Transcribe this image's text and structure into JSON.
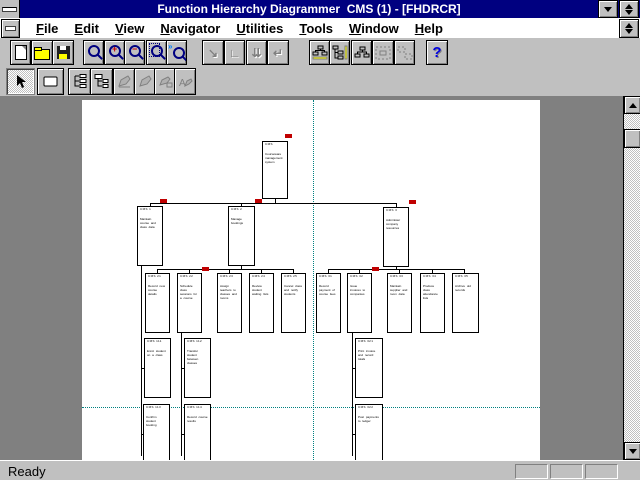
{
  "window": {
    "title": "Function Hierarchy Diagrammer  CMS (1) - [FHDRCR]",
    "buttons": {
      "minimize": "minimize",
      "restore": "restore",
      "system_menu": "system-menu"
    }
  },
  "menu": {
    "items": [
      {
        "label": "File"
      },
      {
        "label": "Edit"
      },
      {
        "label": "View"
      },
      {
        "label": "Navigator"
      },
      {
        "label": "Utilities"
      },
      {
        "label": "Tools"
      },
      {
        "label": "Window"
      },
      {
        "label": "Help"
      }
    ]
  },
  "toolbar_row1": [
    {
      "name": "new-button",
      "icon": "new",
      "x": 10,
      "w": 19,
      "enabled": true
    },
    {
      "name": "open-button",
      "icon": "open",
      "x": 31,
      "w": 20,
      "enabled": true
    },
    {
      "name": "save-button",
      "icon": "save",
      "x": 52,
      "w": 20,
      "enabled": true
    },
    {
      "name": "zoom-button",
      "icon": "mag",
      "x": 83,
      "w": 19,
      "enabled": true
    },
    {
      "name": "zoom-in-button",
      "icon": "magplus",
      "x": 104,
      "w": 19,
      "enabled": true
    },
    {
      "name": "zoom-out-button",
      "icon": "magminus",
      "x": 124,
      "w": 19,
      "enabled": true
    },
    {
      "name": "zoom-fit-button",
      "icon": "magpage",
      "x": 146,
      "w": 19,
      "enabled": true
    },
    {
      "name": "zoom-selection-button",
      "icon": "magsel",
      "x": 166,
      "w": 19,
      "enabled": true
    },
    {
      "name": "expand-node-button",
      "icon": "arr1",
      "x": 202,
      "w": 20,
      "enabled": false
    },
    {
      "name": "collapse-node-button",
      "icon": "arr2",
      "x": 224,
      "w": 19,
      "enabled": false
    },
    {
      "name": "expand-all-button",
      "icon": "arr3",
      "x": 246,
      "w": 19,
      "enabled": false
    },
    {
      "name": "collapse-all-button",
      "icon": "arr4",
      "x": 267,
      "w": 20,
      "enabled": false
    },
    {
      "name": "layout-horizontal-button",
      "icon": "lay1",
      "x": 309,
      "w": 19,
      "enabled": true
    },
    {
      "name": "layout-vertical-button",
      "icon": "lay2",
      "x": 329,
      "w": 19,
      "enabled": true
    },
    {
      "name": "layout-hybrid-button",
      "icon": "lay3",
      "x": 351,
      "w": 19,
      "enabled": true
    },
    {
      "name": "layout-selection-button",
      "icon": "lay4",
      "x": 372,
      "w": 20,
      "enabled": false
    },
    {
      "name": "layout-compact-button",
      "icon": "lay5",
      "x": 394,
      "w": 19,
      "enabled": false
    },
    {
      "name": "help-button",
      "icon": "help",
      "x": 426,
      "w": 20,
      "enabled": true
    }
  ],
  "toolbar_row2": [
    {
      "name": "select-tool",
      "icon": "cursor",
      "x": 6,
      "w": 27,
      "enabled": true,
      "pressed": true
    },
    {
      "name": "function-box-tool",
      "icon": "rect",
      "x": 37,
      "w": 25,
      "enabled": true
    },
    {
      "name": "expand-hierarchy-tool",
      "icon": "tree1",
      "x": 68,
      "w": 21,
      "enabled": true
    },
    {
      "name": "collapse-hierarchy-tool",
      "icon": "tree2",
      "x": 90,
      "w": 21,
      "enabled": true
    },
    {
      "name": "edit-function-tool",
      "icon": "pen1",
      "x": 113,
      "w": 20,
      "enabled": false
    },
    {
      "name": "edit-label-tool",
      "icon": "pen2",
      "x": 134,
      "w": 20,
      "enabled": false
    },
    {
      "name": "fill-color-tool",
      "icon": "pen3",
      "x": 154,
      "w": 20,
      "enabled": false
    },
    {
      "name": "text-style-tool",
      "icon": "pen4",
      "x": 174,
      "w": 20,
      "enabled": false
    }
  ],
  "statusbar": {
    "ready": "Ready",
    "panel_count": 3
  },
  "colors": {
    "titlebar": "#000080",
    "desktop": "#808080",
    "chrome": "#C0C0C0",
    "flag": "#C00000",
    "guide": "#008080",
    "help_icon": "#0000E0"
  },
  "diagram": {
    "guides": {
      "vertical_x": 231,
      "horizontal_y": 307
    },
    "flags": [
      [
        203,
        34
      ],
      [
        78,
        99
      ],
      [
        173,
        99
      ],
      [
        327,
        100
      ],
      [
        120,
        167
      ],
      [
        290,
        167
      ]
    ],
    "connectors": [
      [
        193,
        99,
        1,
        4
      ],
      [
        68,
        103,
        247,
        1
      ],
      [
        68,
        104,
        1,
        3
      ],
      [
        159,
        104,
        1,
        3
      ],
      [
        314,
        104,
        1,
        4
      ],
      [
        159,
        166,
        1,
        3
      ],
      [
        75,
        169,
        137,
        1
      ],
      [
        75,
        170,
        1,
        3
      ],
      [
        107,
        170,
        1,
        3
      ],
      [
        147,
        170,
        1,
        3
      ],
      [
        179,
        170,
        1,
        3
      ],
      [
        211,
        170,
        1,
        3
      ],
      [
        314,
        167,
        1,
        2
      ],
      [
        246,
        169,
        137,
        1
      ],
      [
        246,
        170,
        1,
        3
      ],
      [
        277,
        170,
        1,
        3
      ],
      [
        317,
        170,
        1,
        3
      ],
      [
        350,
        170,
        1,
        3
      ],
      [
        382,
        170,
        1,
        3
      ],
      [
        59,
        166,
        1,
        190
      ],
      [
        99,
        233,
        1,
        123
      ],
      [
        270,
        233,
        1,
        123
      ],
      [
        59,
        268,
        4,
        1
      ],
      [
        99,
        268,
        4,
        1
      ],
      [
        270,
        268,
        4,
        1
      ],
      [
        59,
        334,
        4,
        1
      ],
      [
        99,
        334,
        4,
        1
      ],
      [
        270,
        334,
        4,
        1
      ],
      [
        276,
        238,
        1,
        60
      ],
      [
        276,
        304,
        1,
        56
      ]
    ],
    "boxes": [
      {
        "id": "root-function",
        "x": 180,
        "y": 41,
        "w": 26,
        "h": 58,
        "code": "CMS",
        "desc": "Courseware management system"
      },
      {
        "id": "function-1",
        "x": 55,
        "y": 106,
        "w": 26,
        "h": 60,
        "code": "CMS 1",
        "desc": "Maintain course and class data"
      },
      {
        "id": "function-2",
        "x": 146,
        "y": 106,
        "w": 27,
        "h": 60,
        "code": "CMS 2",
        "desc": "Manage bookings"
      },
      {
        "id": "function-3",
        "x": 301,
        "y": 107,
        "w": 26,
        "h": 60,
        "code": "CMS 3",
        "desc": "Administer company resources"
      },
      {
        "id": "function-2-1",
        "x": 63,
        "y": 173,
        "w": 25,
        "h": 60,
        "code": "CMS 21",
        "desc": "Record new course details"
      },
      {
        "id": "function-2-2",
        "x": 95,
        "y": 173,
        "w": 25,
        "h": 60,
        "code": "CMS 22",
        "desc": "Schedule class sessions for a course"
      },
      {
        "id": "function-2-3",
        "x": 135,
        "y": 173,
        "w": 25,
        "h": 60,
        "code": "CMS 23",
        "desc": "Assign teachers to classes and rooms"
      },
      {
        "id": "function-2-4",
        "x": 167,
        "y": 173,
        "w": 25,
        "h": 60,
        "code": "CMS 24",
        "desc": "Review student waiting lists"
      },
      {
        "id": "function-2-5",
        "x": 199,
        "y": 173,
        "w": 25,
        "h": 60,
        "code": "CMS 25",
        "desc": "Cancel class and notify students"
      },
      {
        "id": "function-3-1",
        "x": 234,
        "y": 173,
        "w": 25,
        "h": 60,
        "code": "CMS 31",
        "desc": "Record payment of course fees"
      },
      {
        "id": "function-3-2",
        "x": 265,
        "y": 173,
        "w": 25,
        "h": 60,
        "code": "CMS 32",
        "desc": "Issue invoices to companies"
      },
      {
        "id": "function-3-3",
        "x": 305,
        "y": 173,
        "w": 25,
        "h": 60,
        "code": "CMS 33",
        "desc": "Maintain supplier and room data"
      },
      {
        "id": "function-3-4",
        "x": 338,
        "y": 173,
        "w": 25,
        "h": 60,
        "code": "CMS 34",
        "desc": "Produce class attendance lists"
      },
      {
        "id": "function-3-5",
        "x": 370,
        "y": 173,
        "w": 27,
        "h": 60,
        "code": "CMS 35",
        "desc": "Archive old records"
      },
      {
        "id": "function-1-1",
        "x": 62,
        "y": 238,
        "w": 27,
        "h": 60,
        "code": "CMS 111",
        "desc": "Enrol student on a class"
      },
      {
        "id": "function-1-2",
        "x": 102,
        "y": 238,
        "w": 27,
        "h": 60,
        "code": "CMS 112",
        "desc": "Transfer student between classes"
      },
      {
        "id": "function-3-2-1",
        "x": 273,
        "y": 238,
        "w": 28,
        "h": 60,
        "code": "CMS 321",
        "desc": "Print invoice and record totals"
      },
      {
        "id": "function-1-3",
        "x": 61,
        "y": 304,
        "w": 27,
        "h": 60,
        "code": "CMS 113",
        "desc": "Confirm student booking"
      },
      {
        "id": "function-1-4",
        "x": 102,
        "y": 304,
        "w": 27,
        "h": 60,
        "code": "CMS 114",
        "desc": "Record course results"
      },
      {
        "id": "function-3-2-2",
        "x": 273,
        "y": 304,
        "w": 28,
        "h": 60,
        "code": "CMS 322",
        "desc": "Post payments to ledger"
      }
    ]
  }
}
